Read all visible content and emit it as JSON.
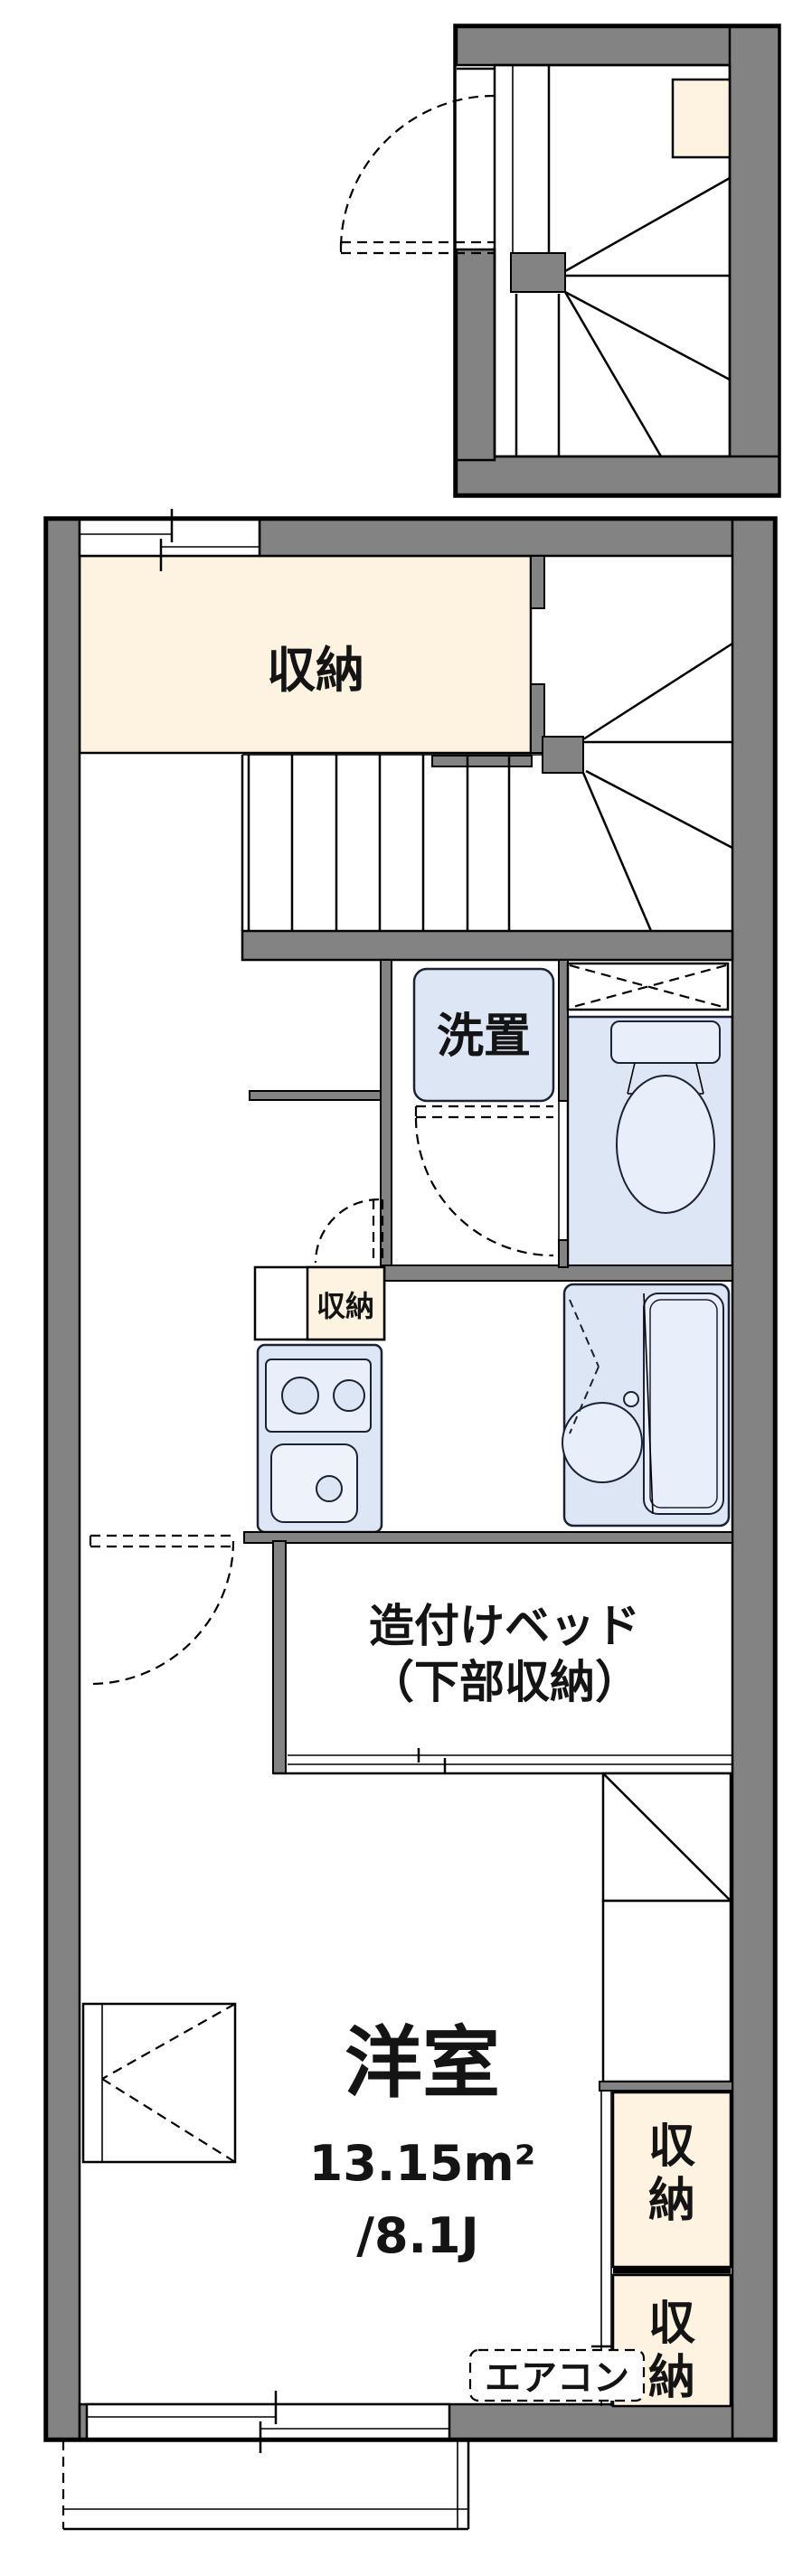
{
  "document": {
    "type": "floor-plan",
    "description": "Japanese apartment unit floor plan with internal winder staircase"
  },
  "labels": {
    "storage": "収納",
    "laundry": "洗置",
    "built_in_bed_1": "造付けベッド",
    "built_in_bed_2": "（下部収納）",
    "room_name": "洋室",
    "room_area_m2": "13.15m²",
    "room_area_jo": "/8.1J",
    "aircon": "エアコン",
    "storage_chars": [
      "収",
      "納"
    ]
  },
  "colors": {
    "wall_gray": "#838383",
    "storage_cream": "#fdf3e0",
    "fixture_blue": "#dce6f4",
    "fixture_stroke": "#1b2235",
    "line_black": "#000000",
    "background": "#ffffff"
  }
}
